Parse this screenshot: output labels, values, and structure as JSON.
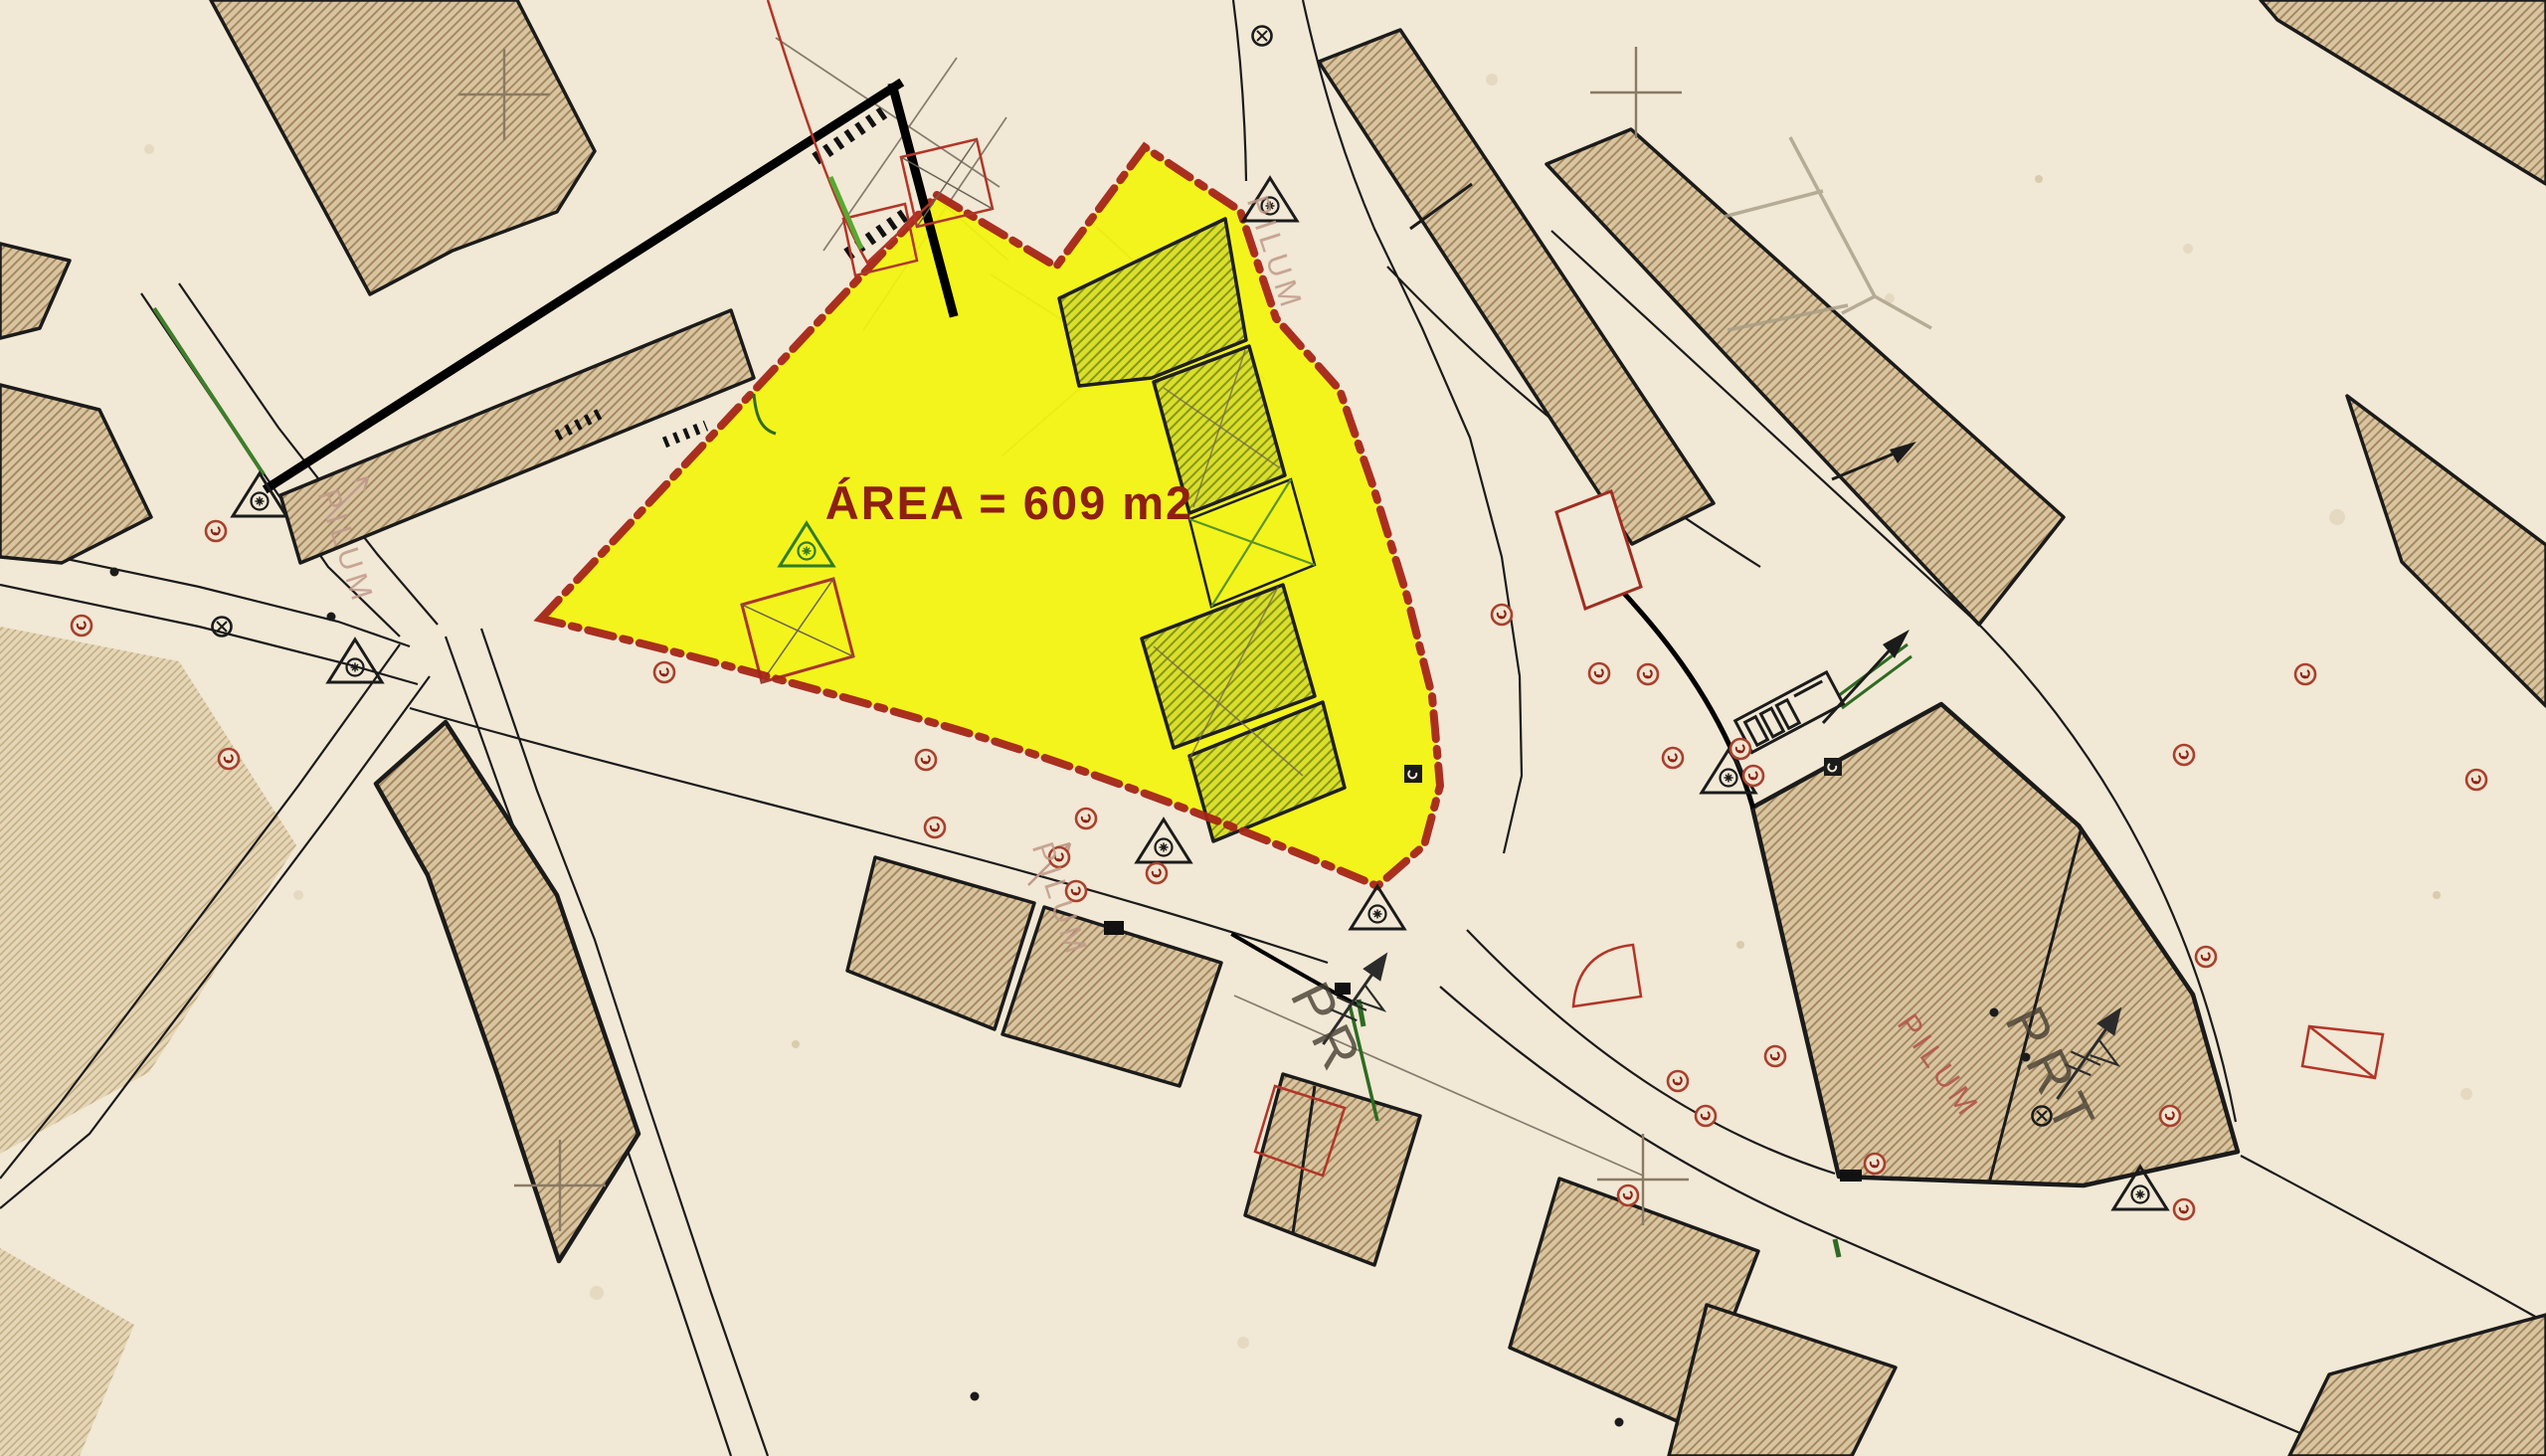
{
  "document": {
    "kind": "scanned cadastral survey plan with highlighted parcel",
    "parcel": {
      "area_label": "ÁREA = 609 m2",
      "area_value_m2": 609,
      "highlight_color": "#f3f40e",
      "boundary_color": "#a42518",
      "boundary_style": "dash-dot"
    },
    "street_labels": [
      {
        "text": "PILUM"
      },
      {
        "text": "PILUM"
      },
      {
        "text": "PILUM"
      },
      {
        "text": "PILUM"
      }
    ],
    "survey_marks": [
      {
        "text": "PR"
      },
      {
        "text": "PRT"
      }
    ],
    "colors": {
      "paper": "#f1e8d5",
      "block_fill": "#d8c5a0",
      "block_hatch": "#a3865e",
      "ink": "#1a1a1a",
      "red_annotation": "#b23527",
      "green_annotation": "#2e7d24",
      "area_label_red": "#8e1f12",
      "faded_label": "#c09a8a"
    },
    "symbols": [
      "triangle-station-icon",
      "red-circle-marker-icon",
      "black-circle-marker-icon",
      "grid-cross-icon",
      "direction-arrow-icon",
      "range-pole-icon",
      "utility-box-icon"
    ]
  }
}
